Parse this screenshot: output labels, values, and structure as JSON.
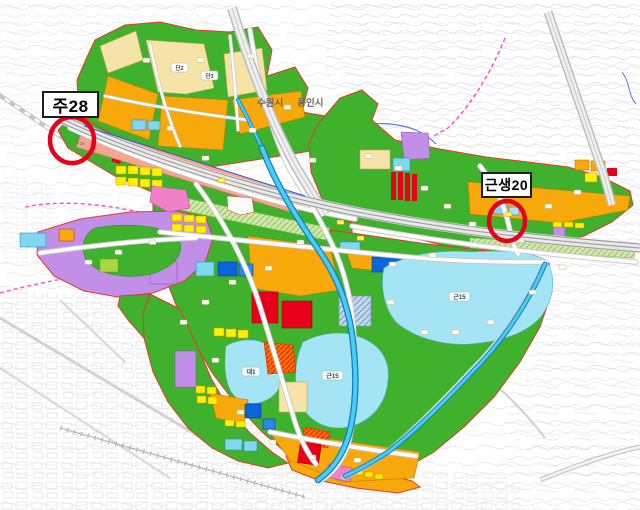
{
  "annotations": {
    "left": {
      "label": "주28"
    },
    "right": {
      "label": "근생20"
    }
  },
  "cities": {
    "suwon": "수원시",
    "yongin": "용인시"
  },
  "zone_labels": [
    {
      "text": "단2"
    },
    {
      "text": "단3"
    },
    {
      "text": "근15"
    },
    {
      "text": "근15"
    },
    {
      "text": "대1"
    },
    {
      "text": "주28"
    }
  ],
  "palette": {
    "park_green": "#3FB12C",
    "residential_orange": "#F7A80B",
    "low_density_cream": "#F6E3A8",
    "detached_yellow": "#FFF100",
    "water_cyan": "#A4E4F4",
    "parcel_cyan": "#7FD8F0",
    "school_blue": "#0A64DC",
    "commercial_red": "#E8001A",
    "mixed_orange_red": "#FF6F00",
    "greenbelt_purple": "#C18FE8",
    "corridor_salmon": "#F6A48E",
    "pink_zone": "#F080C8",
    "khaki_zone": "#D9CD8C",
    "annotation_circle_red": "#E8001A",
    "district_boundary_red": "#E8382A",
    "road_white": "#FFFFFF",
    "rail_gray": "#9C9C9C",
    "contour_gray": "#E3E3E3",
    "stream_blue": "#2F6FD6",
    "river_cyan": "#45D0F0",
    "planning_dash_magenta": "#FF4FC8"
  }
}
